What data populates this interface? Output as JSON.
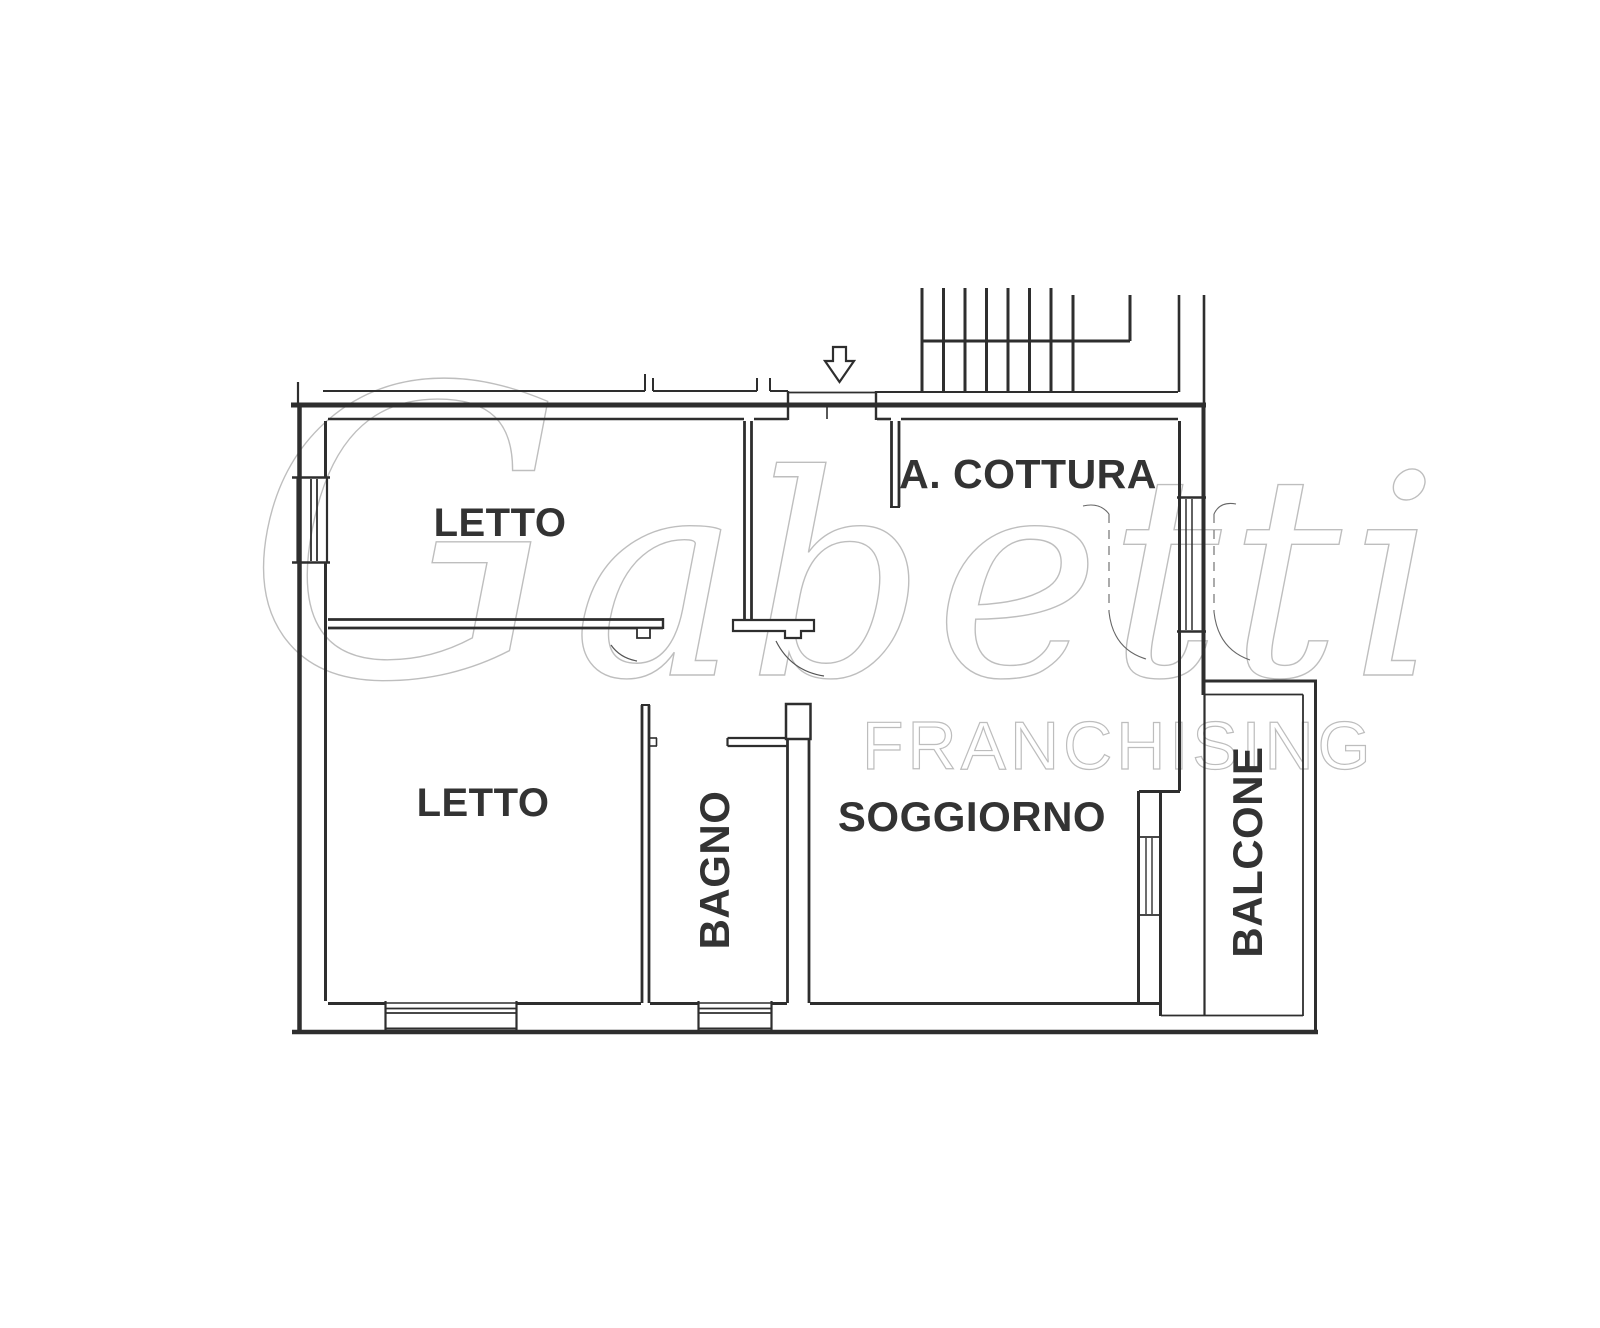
{
  "canvas": {
    "width": 1600,
    "height": 1328,
    "background": "#ffffff",
    "line_color": "#2e2e2e"
  },
  "watermark": {
    "brand_initial": "G",
    "brand_rest": "abetti",
    "sub": "FRANCHISING"
  },
  "rooms": [
    {
      "id": "letto-1",
      "label": "LETTO",
      "x": 500,
      "y": 536,
      "size": 40,
      "rot": 0
    },
    {
      "id": "letto-2",
      "label": "LETTO",
      "x": 483,
      "y": 816,
      "size": 40,
      "rot": 0
    },
    {
      "id": "bagno",
      "label": "BAGNO",
      "x": 729,
      "y": 870,
      "size": 42,
      "rot": -90
    },
    {
      "id": "angolo-cottura",
      "label": "A. COTTURA",
      "x": 1028,
      "y": 488,
      "size": 41,
      "rot": 0
    },
    {
      "id": "soggiorno",
      "label": "SOGGIORNO",
      "x": 972,
      "y": 831,
      "size": 42,
      "rot": 0
    },
    {
      "id": "balcone",
      "label": "BALCONE",
      "x": 1262,
      "y": 852,
      "size": 42,
      "rot": -90
    }
  ],
  "geometry": {
    "segments": [
      [
        323,
        391,
        645,
        391,
        2
      ],
      [
        645,
        391,
        645,
        374,
        2
      ],
      [
        653,
        391,
        653,
        378,
        2
      ],
      [
        653,
        391,
        757,
        391,
        2
      ],
      [
        757,
        391,
        757,
        378,
        2
      ],
      [
        770,
        391,
        770,
        378,
        2
      ],
      [
        770,
        391,
        788,
        391,
        2
      ],
      [
        298,
        382,
        298,
        404,
        2.2
      ],
      [
        788,
        392.5,
        876,
        392.5,
        1.8
      ],
      [
        877,
        392,
        1178,
        392,
        2
      ],
      [
        922,
        288,
        922,
        392,
        3
      ],
      [
        943.5,
        288,
        943.5,
        392,
        3
      ],
      [
        965,
        288,
        965,
        392,
        3
      ],
      [
        986.5,
        288,
        986.5,
        392,
        3
      ],
      [
        1008,
        288,
        1008,
        392,
        3
      ],
      [
        1029.5,
        288,
        1029.5,
        392,
        3
      ],
      [
        1051,
        288,
        1051,
        392,
        3
      ],
      [
        1073,
        295,
        1073,
        392,
        3
      ],
      [
        922,
        341,
        1130,
        341,
        3
      ],
      [
        1130,
        341,
        1130,
        295,
        3
      ],
      [
        1179,
        295,
        1179,
        392,
        2.6
      ],
      [
        1204,
        295,
        1204,
        405,
        2.6
      ],
      [
        291,
        405,
        1206,
        405,
        5
      ],
      [
        328,
        419,
        744,
        419,
        2.6
      ],
      [
        754,
        419,
        788,
        419,
        2.6
      ],
      [
        877,
        419,
        891,
        419,
        2.6
      ],
      [
        901,
        419,
        1178,
        419,
        2.6
      ],
      [
        788,
        391,
        788,
        420,
        2.4
      ],
      [
        876,
        391,
        876,
        420,
        2.4
      ],
      [
        827,
        406,
        827,
        419,
        1.6
      ],
      [
        299.5,
        405,
        299.5,
        1032,
        4.5
      ],
      [
        325.5,
        421,
        325.5,
        478,
        3
      ],
      [
        325.5,
        562,
        325.5,
        1001,
        3
      ],
      [
        297.5,
        477,
        297.5,
        563,
        2.2
      ],
      [
        311,
        479,
        311,
        561,
        1.8
      ],
      [
        317,
        479,
        317,
        561,
        1.8
      ],
      [
        327,
        477,
        327,
        563,
        2.2
      ],
      [
        292,
        477.5,
        330,
        477.5,
        2.4
      ],
      [
        292,
        562.5,
        330,
        562.5,
        2.4
      ],
      [
        292,
        1032,
        1318,
        1032,
        4.5
      ],
      [
        328,
        1003.5,
        385,
        1003.5,
        3
      ],
      [
        517,
        1003.5,
        641,
        1003.5,
        3
      ],
      [
        650,
        1003.5,
        698,
        1003.5,
        3
      ],
      [
        772,
        1003.5,
        787,
        1003.5,
        3
      ],
      [
        810,
        1003.5,
        1161,
        1003.5,
        3
      ],
      [
        385.5,
        1001,
        385.5,
        1030,
        2.2
      ],
      [
        516.5,
        1001,
        516.5,
        1030,
        2.2
      ],
      [
        386,
        1003,
        516,
        1003,
        1.6
      ],
      [
        386,
        1008.5,
        516,
        1008.5,
        1.8
      ],
      [
        386,
        1013,
        516,
        1013,
        1.8
      ],
      [
        386,
        1028.5,
        516,
        1028.5,
        2
      ],
      [
        698.5,
        1001,
        698.5,
        1030,
        2.2
      ],
      [
        771.5,
        1001,
        771.5,
        1030,
        2.2
      ],
      [
        699,
        1003,
        771,
        1003,
        1.6
      ],
      [
        699,
        1008.5,
        771,
        1008.5,
        1.8
      ],
      [
        699,
        1013,
        771,
        1013,
        1.8
      ],
      [
        699,
        1028.5,
        771,
        1028.5,
        2
      ],
      [
        1179.5,
        421,
        1179.5,
        791,
        3
      ],
      [
        1203.5,
        405,
        1203.5,
        695,
        4
      ],
      [
        1177,
        497.5,
        1206,
        497.5,
        2.4
      ],
      [
        1177,
        631.5,
        1206,
        631.5,
        2.4
      ],
      [
        1186,
        499,
        1186,
        630,
        1.5
      ],
      [
        1192,
        499,
        1192,
        630,
        1.5
      ],
      [
        1139,
        791.5,
        1180,
        791.5,
        3
      ],
      [
        1138.5,
        791,
        1138.5,
        1003,
        3
      ],
      [
        1160.5,
        791,
        1160.5,
        1016,
        3
      ],
      [
        1137,
        837,
        1162,
        837,
        1.8
      ],
      [
        1137,
        915,
        1162,
        915,
        1.8
      ],
      [
        1146,
        838,
        1146,
        914,
        1.4
      ],
      [
        1152,
        838,
        1152,
        914,
        1.4
      ],
      [
        1204.5,
        695,
        1204.5,
        1015,
        2.2
      ],
      [
        1205,
        681,
        1317,
        681,
        3
      ],
      [
        1315.5,
        681,
        1315.5,
        1032,
        3
      ],
      [
        1205,
        694.5,
        1303,
        694.5,
        1.8
      ],
      [
        1303,
        694.5,
        1303,
        1016,
        1.8
      ],
      [
        1161,
        1015.5,
        1303,
        1015.5,
        1.8
      ],
      [
        744.5,
        421,
        744.5,
        619,
        2.8
      ],
      [
        751.5,
        421,
        751.5,
        619,
        2.8
      ],
      [
        328,
        619.5,
        663,
        619.5,
        2.8
      ],
      [
        328,
        628,
        663,
        628,
        2.8
      ],
      [
        663,
        618,
        663,
        629,
        2.4
      ],
      [
        891.5,
        421,
        891.5,
        507,
        2.8
      ],
      [
        899,
        421,
        899,
        507,
        2.8
      ],
      [
        890,
        507,
        900,
        507,
        2
      ],
      [
        642,
        705,
        642,
        1003,
        2.8
      ],
      [
        649,
        705,
        649,
        1003,
        2.8
      ],
      [
        641,
        705,
        650,
        705,
        2
      ],
      [
        650,
        738,
        657,
        738,
        1.6
      ],
      [
        650,
        746,
        657,
        746,
        1.6
      ],
      [
        656.5,
        738,
        656.5,
        746,
        1.6
      ],
      [
        727.5,
        738,
        787,
        738,
        2.2
      ],
      [
        727.5,
        746,
        787,
        746,
        2.2
      ],
      [
        727.5,
        738,
        727.5,
        746,
        2.2
      ],
      [
        787.5,
        739,
        787.5,
        1003,
        2.8
      ],
      [
        809,
        739,
        809,
        1003,
        2.8
      ]
    ],
    "paths": [
      {
        "name": "entry-arrow-icon",
        "d": "M833 347 H846 V361 H854 L839.5 382 L825 361 H833 Z",
        "w": 2.2,
        "fill": "#ffffff"
      },
      {
        "name": "hall-wall-foot",
        "d": "M733 620 H814 V631 H801 V638 H785 V631 H733 Z",
        "w": 2.2,
        "fill": "#ffffff"
      },
      {
        "name": "letto-door-jamb",
        "d": "M637 628 H650 V638 H637 Z",
        "w": 1.8,
        "fill": "#ffffff"
      },
      {
        "name": "bagno-wall-head",
        "d": "M786 704 H810.5 V739 H786 Z",
        "w": 2.5,
        "fill": "#ffffff"
      },
      {
        "name": "door-swing-arc",
        "d": "M776 641 Q791 671 824 676",
        "w": 1.2,
        "stroke": "#555555"
      },
      {
        "name": "door-swing-arc",
        "d": "M611 645 Q620 658 637 661",
        "w": 1.2,
        "stroke": "#555555"
      },
      {
        "name": "window-swing-arc",
        "d": "M1083 506 Q1100 502 1109 514",
        "w": 1.1,
        "stroke": "#666666"
      },
      {
        "name": "window-swing-arc",
        "d": "M1109 514 V612",
        "w": 1.1,
        "stroke": "#666666",
        "dash": "9 7"
      },
      {
        "name": "window-swing-arc",
        "d": "M1109 612 Q1113 649 1146 659",
        "w": 1.1,
        "stroke": "#666666"
      },
      {
        "name": "window-swing-arc",
        "d": "M1236 504 Q1220 501 1214 514",
        "w": 1.1,
        "stroke": "#666666"
      },
      {
        "name": "window-swing-arc",
        "d": "M1214 514 V612",
        "w": 1.1,
        "stroke": "#666666",
        "dash": "9 7"
      },
      {
        "name": "window-swing-arc",
        "d": "M1214 612 Q1218 649 1250 660",
        "w": 1.1,
        "stroke": "#666666"
      }
    ]
  }
}
